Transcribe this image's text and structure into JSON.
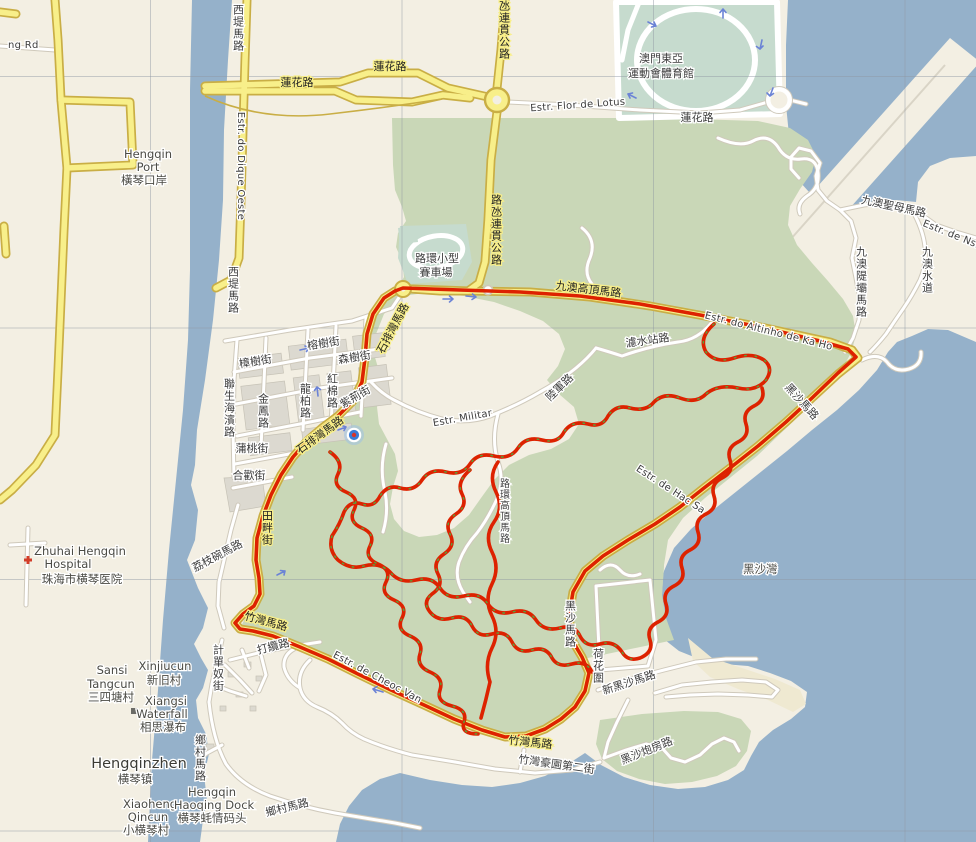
{
  "map": {
    "type": "street-map-with-gps-track",
    "area": "Coloane (Macau) / Hengqin (Zhuhai)",
    "colors": {
      "land": "#f3efe3",
      "water": "#95b1ca",
      "vegetation": "#c9d7b7",
      "sports_field": "#c6dbce",
      "major_road": "#f8ef8a",
      "major_road_casing": "#c9ae45",
      "minor_road": "#ffffff",
      "gps_track": "#dd2200",
      "track_points": "#57a33c",
      "building": "#dcd9d0",
      "oneway_arrow": "#6b83d6",
      "location_dot": "#3a7bd5",
      "hospital_cross": "#d23d29",
      "label_text": "#3c3c3c"
    },
    "labels": {
      "ng_rd": "ng Rd",
      "lotus_w": "蓮花路",
      "lotus_mid": "蓮花路",
      "lotus_e": "蓮花路",
      "xidi_top": "西堤馬路",
      "xidi_mid": "西堤馬路",
      "dique_oeste": "Estr. do Dique Oeste",
      "cotai_hwy_top": "路氹連貫公路",
      "cotai_hwy_mid": "路氹連貫公路",
      "hengqin_port_1": "Hengqin",
      "hengqin_port_2": "Port",
      "hengqin_port_3": "橫琴口岸",
      "flor_lotus": "Estr. Flor de Lotus",
      "stadium_1": "澳門東亞",
      "stadium_2": "運動會體育館",
      "karting_1": "路環小型",
      "karting_2": "賽車場",
      "kaho_alto_zh": "九澳高頂馬路",
      "kaho_alto_en": "Estr. do Altinho de Ka Ho",
      "filter_rd": "濾水站路",
      "nsra_zh": "九澳聖母馬路",
      "nsra_en": "Estr. de Ns.",
      "dyke_rd": "九澳隄壩馬路",
      "kaho_path": "九澳水道",
      "hacsa_rd_ne": "黑沙馬路",
      "hacsa_rd_s": "黑沙馬路",
      "estr_hac_sa": "Estr. de Hac Sa",
      "hacsa_bay": "黑沙灣",
      "hehua": "荷花圍",
      "new_hacsa": "新黑沙馬路",
      "paofang": "黑沙炮房路",
      "cheocvan_w": "竹灣馬路",
      "cheocvan_s": "竹灣馬路",
      "cheocvan_est": "Estr. de Cheoc Van",
      "cheocvan_2nd": "竹灣豪園第二街",
      "tianpan": "田畔街",
      "laichiwan": "荔枝碗馬路",
      "caetano": "計單奴街",
      "talam": "打纜路",
      "village_rd_1": "鄉村馬路",
      "village_rd_2": "鄉村馬路",
      "sansi_1": "Sansi",
      "sansi_2": "Tangcun",
      "sansi_3": "三四塘村",
      "xinjiu_1": "Xinjiucun",
      "xinjiu_2": "新旧村",
      "xiangsi_1": "Xiangsi",
      "xiangsi_2": "Waterfall",
      "xiangsi_3": "相思瀑布",
      "hqz_1": "Hengqinzhen",
      "hqz_2": "横琴镇",
      "xhq_1": "Xiaoheng",
      "xhq_2": "Qincun",
      "xhq_3": "小横琴村",
      "dock_1": "Hengqin",
      "dock_2": "Haoqing Dock",
      "dock_3": "横琴蚝情码头",
      "hosp_1": "Zhuhai Hengqin",
      "hosp_2": "Hospital",
      "hosp_3": "珠海市横琴医院",
      "st_banyan": "榕樹街",
      "st_camphor": "樟樹街",
      "st_sam": "森樹街",
      "st_redcotton": "紅棉路",
      "st_lungpaak": "龍柏路",
      "st_chiking": "紫荊街",
      "st_kamfung": "金鳳路",
      "st_linsang": "聯生海濱路",
      "st_poutou": "蒲桃街",
      "st_hopfun": "合歡街",
      "seac_1": "石排灣馬路",
      "seac_2": "石排灣馬路",
      "militar": "Estr. Militar",
      "lukkwan": "陸軍路",
      "alto_col": "路環高頂馬路"
    }
  }
}
